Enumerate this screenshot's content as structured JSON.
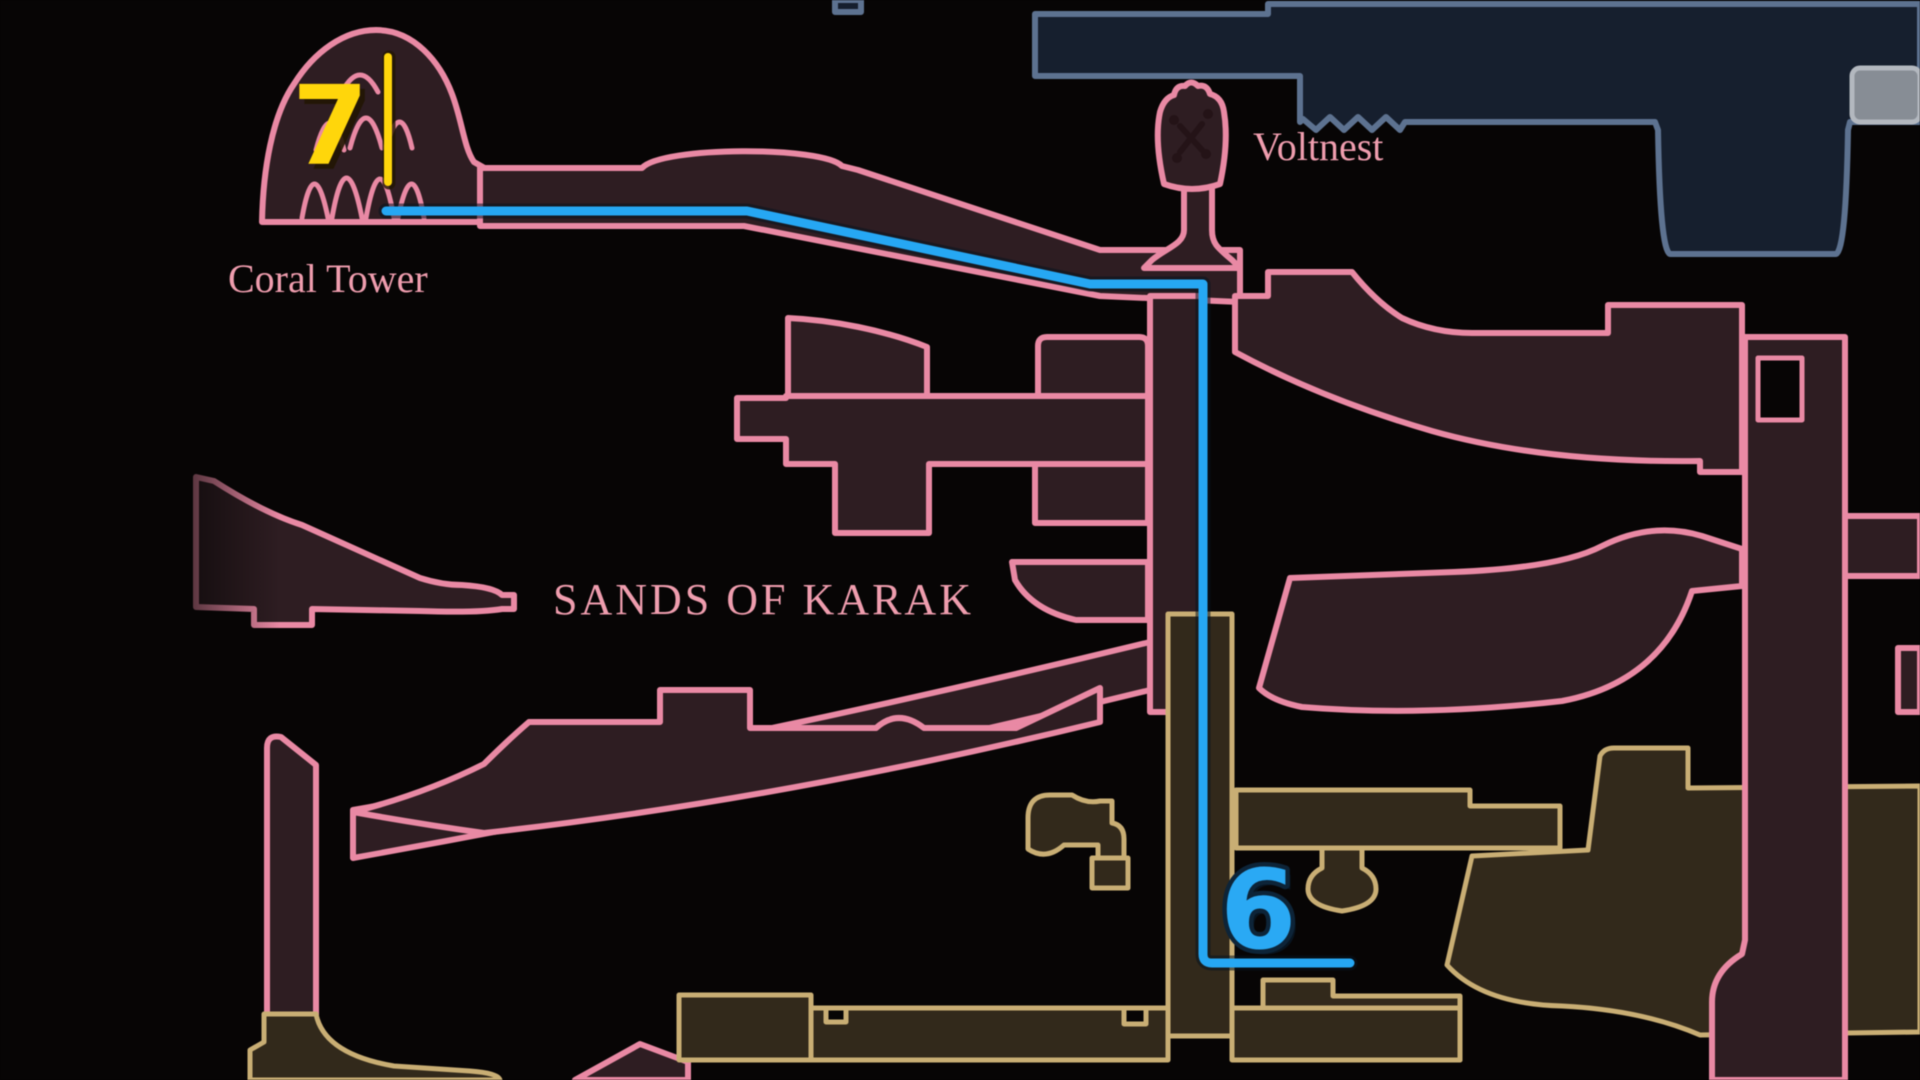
{
  "map": {
    "labels": {
      "coral_tower": "Coral Tower",
      "voltnest": "Voltnest",
      "zone_title": "SANDS OF KARAK"
    },
    "markers": {
      "seven": {
        "value": "7",
        "color": "#ffd60b",
        "shadow": "#221603",
        "pin_line_color": "#ffd60b"
      },
      "six": {
        "value": "6",
        "color": "#2aa9f4",
        "outline": "#0d2438",
        "shadow": "#08141f"
      }
    },
    "route": {
      "color": "#26a7f3",
      "halo": "#08141f"
    },
    "colors": {
      "background": "#070505",
      "pink_outline": "#e989a4",
      "pink_fill": "#2e1d22",
      "tan_outline": "#c9ae74",
      "tan_fill": "#32291b",
      "navy_outline": "#5d7290",
      "navy_fill": "#161f2e",
      "gray_fill": "#878d95",
      "gray_outline": "#b3b8bf",
      "text_pink": "#ef9dae",
      "decor_dark": "#241317"
    }
  }
}
